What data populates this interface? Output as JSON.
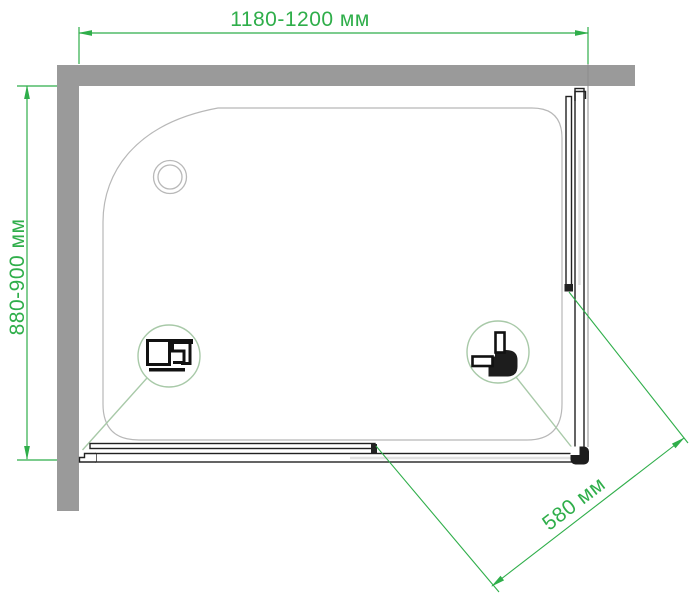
{
  "drawing": {
    "subject": "corner shower enclosure top view technical drawing",
    "dimensions": {
      "width_label": "1180-1200 мм",
      "depth_label": "880-900 мм",
      "entry_label": "580 мм"
    },
    "icons": {
      "drain": "drain-circle-icon",
      "left_callout": "wall-profile-detail-icon",
      "right_callout": "corner-profile-detail-icon"
    },
    "colors": {
      "dimension_green": "#2fae4a",
      "callout_green": "#a8c9a8",
      "wall_gray": "#9a9a9a",
      "tray_outline": "#b8b8b8",
      "profile_dark": "#1d1d1d"
    }
  }
}
